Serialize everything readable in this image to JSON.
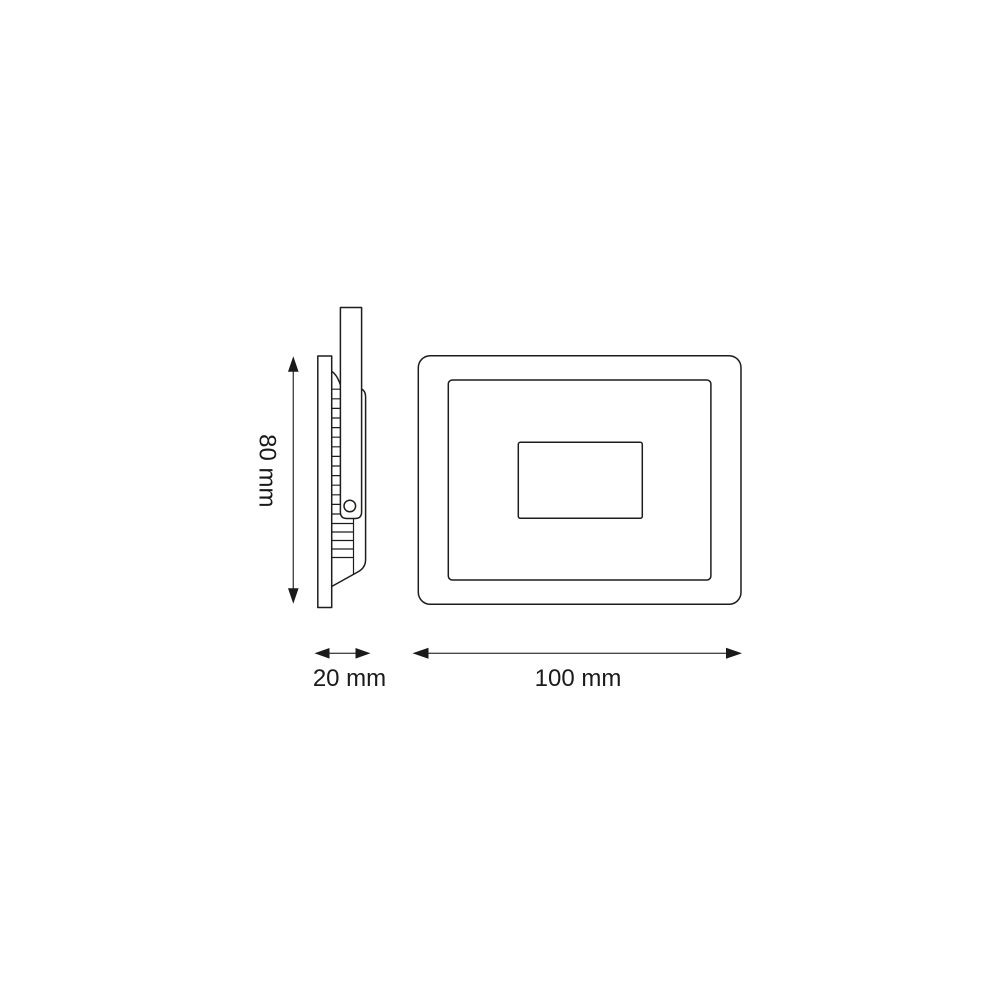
{
  "page": {
    "background": "#ffffff"
  },
  "diagram": {
    "colors": {
      "line": "#1d1d1b",
      "arrow_shaft": "#4a4a4a",
      "arrow_head": "#1a1a1a",
      "text": "#1a1a1a"
    },
    "dimensions": {
      "height": {
        "label": "80 mm",
        "value": 80,
        "unit": "mm",
        "orientation": "vertical"
      },
      "depth": {
        "label": "20 mm",
        "value": 20,
        "unit": "mm",
        "orientation": "horizontal"
      },
      "width": {
        "label": "100 mm",
        "value": 100,
        "unit": "mm",
        "orientation": "horizontal"
      }
    }
  }
}
